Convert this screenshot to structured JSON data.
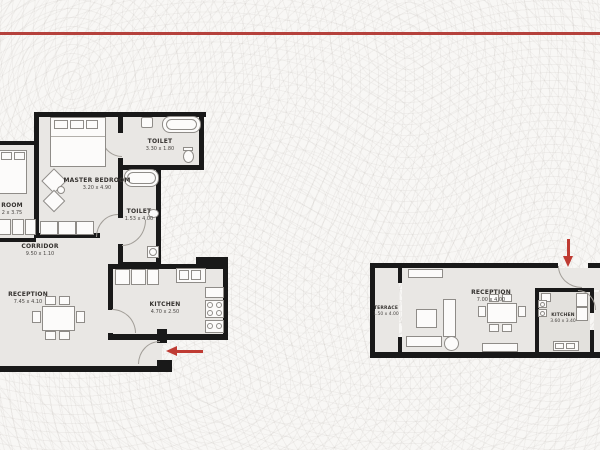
{
  "divider": {
    "color": "#b5413c"
  },
  "plans": {
    "left": {
      "rooms": {
        "master_bedroom": {
          "name": "MASTER BEDROOM",
          "dims": "3.20 x 4.90"
        },
        "toilet_top": {
          "name": "TOILET",
          "dims": "3.30 x 1.80"
        },
        "toilet_side": {
          "name": "TOILET",
          "dims": "1.53 x 4.00"
        },
        "corridor": {
          "name": "CORRIDOR",
          "dims": "9.50 x 1.10"
        },
        "reception": {
          "name": "RECEPTION",
          "dims": "7.45 x 4.10"
        },
        "kitchen": {
          "name": "KITCHEN",
          "dims": "4.70 x 2.50"
        },
        "bedroom_partial": {
          "name": "ROOM",
          "dims": "2 x 3.75"
        }
      },
      "entrance_arrow_direction": "left"
    },
    "right": {
      "rooms": {
        "terrace": {
          "name": "TERRACE",
          "dims": "1.50 x 4.00"
        },
        "reception": {
          "name": "RECEPTION",
          "dims": "7.00 x 4.00"
        },
        "kitchen": {
          "name": "KITCHEN",
          "dims": "3.60 x 3.40"
        }
      },
      "entrance_arrow_direction": "down"
    }
  },
  "colors": {
    "accent_red": "#b5413c",
    "wall_black": "#191919",
    "floor_gray": "#e9e7e4",
    "background": "#f8f7f5"
  }
}
